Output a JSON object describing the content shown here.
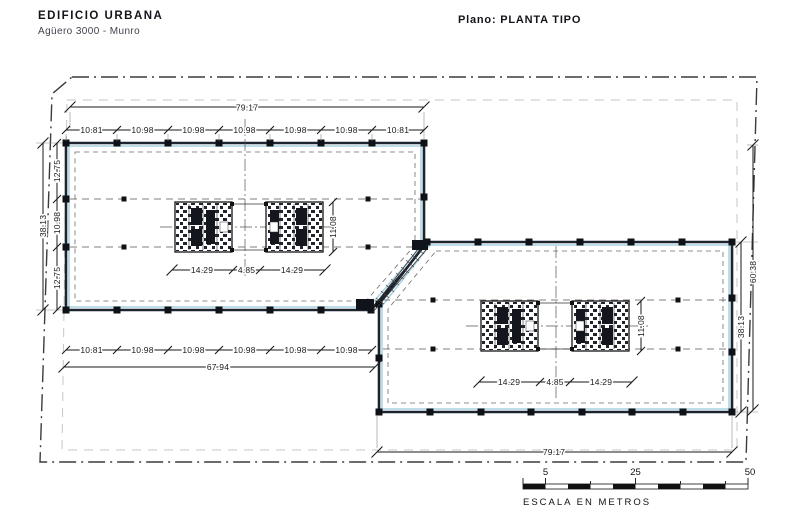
{
  "header": {
    "project_title": "EDIFICIO URBANA",
    "project_subtitle": "Agüero 3000 - Munro",
    "plan_label": "Plano: PLANTA TIPO"
  },
  "dims": {
    "top_total": "79.17",
    "top_bays": [
      "10.81",
      "10.98",
      "10.98",
      "10.98",
      "10.98",
      "10.98",
      "10.81"
    ],
    "left_total": "38.13",
    "left_bays": [
      "12.75",
      "10.98",
      "12.75"
    ],
    "upper_core_width": [
      "14.29",
      "4.85",
      "14.29"
    ],
    "upper_core_depth": "11.08",
    "upper_bottom_bays": [
      "10.81",
      "10.98",
      "10.98",
      "10.98",
      "10.98",
      "10.98"
    ],
    "upper_bottom_total": "67.94",
    "lower_core_width": [
      "14.29",
      "4.85",
      "14.29"
    ],
    "lower_core_depth": "11.08",
    "right_building_total": "38.13",
    "right_site_total": "60.38",
    "bottom_total": "79.17"
  },
  "scale_bar": {
    "tick_labels": [
      "5",
      "25",
      "50"
    ],
    "caption": "ESCALA EN METROS"
  },
  "colors": {
    "line": "#1c2430",
    "glass": "#a9d2e3",
    "boundary": "#3c3c3c",
    "setback": "#c6c6c6",
    "dim": "#1a1a1a"
  }
}
